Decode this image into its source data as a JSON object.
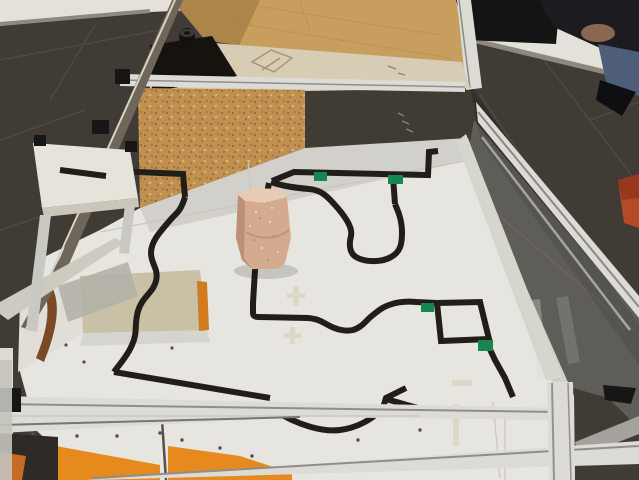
{
  "image": {
    "width": 639,
    "height": 480,
    "kind": "photograph",
    "subject": "Line-following robot test arena: aluminum-profile table with glass side walls, white boards carrying a black tape track with green corner markers, a standing brick obstacle, wooden ramps with orange faces, plywood back wall and cork divider, dark tiled floor, spectator sitting at top right"
  },
  "scene_objects": [
    "dark tiled floor",
    "white wall",
    "plywood back wall",
    "cork divider wall",
    "beige rear compartment board with pencil sketch",
    "black tape roll",
    "aluminum profile frame rails and posts",
    "glass side panels",
    "white track surface boards",
    "black tape track line",
    "green corner markers",
    "standing brick obstacle",
    "wooden ramp wedges with orange faces",
    "small white side table",
    "black corner brackets",
    "spectator sitting on floor",
    "dark bag against wall",
    "orange object at right edge"
  ],
  "colors": {
    "floor": "#403b35",
    "grout": "#5c554b",
    "wall": "#e4e1da",
    "baseboard": "#8e897f",
    "plywood": "#c79e5e",
    "plywood_shade": "#a87f42",
    "cork": "#bf9050",
    "cork_dot": "#8a5f33",
    "beige_floor": "#d7cdb4",
    "dark_gap": "#16130e",
    "surface": "#e7e5df",
    "surface_back_shade": "#b8b5ac",
    "track": "#211e1a",
    "marker": "#17874f",
    "brick_front": "#d5ab90",
    "brick_top": "#e7cbb4",
    "brick_side": "#bc8f78",
    "ramp_tan": "#c8c1a6",
    "ramp_orange": "#e68a1e",
    "ramp_orange_dark": "#cf7b1e",
    "ramp_brown": "#7a4a26",
    "alu_light": "#dcdbd6",
    "alu_mid": "#a3a29c",
    "alu_dark": "#71706b",
    "bronze": "#6e665a",
    "glass": "#b9bbb4",
    "dark_object": "#141414",
    "person_top": "#1c1c20",
    "jeans": "#4f5e78",
    "skin": "#8a6750",
    "shoe": "#0f0f12",
    "orange_object": "#b34a28",
    "bench_top": "#e6e3da",
    "bench_edge": "#cbc6b9",
    "shelf": "#b2afa8",
    "cap_black": "#161616",
    "screw": "#55504a"
  },
  "track": {
    "stroke_width": 6,
    "paths": {
      "bench_line": "M60,169 L104,175 M117,171 L183,174 L185,197",
      "s_curve": "M185,197 C181,210 178,212 172,218 C158,234 151,242 151,253 C151,264 159,269 156,281 C153,293 142,297 138,311 C134,325 138,332 132,345 C127,357 118,366 114,372",
      "ramp_diagonal": "M114,372 L270,398",
      "below_rail": "M272,409 C300,427 325,432 340,430 C356,428 372,420 383,408 M383,408 L386,398 L406,388 M386,399 L407,405 L440,414",
      "top_line": "M272,181 L294,172 L428,175 L429,152 L438,151",
      "stub": "M393,177 L395,204",
      "pocket": "M395,204 C399,213 402,221 402,233 C402,245 400,252 391,257 C381,263 364,262 356,257 C349,253 349,243 351,236 C353,227 344,215 335,205 C327,196 321,190 309,189 C297,188 282,186 271,182",
      "under_brick": "M269,183 L258,240 L255,270",
      "mid_curve": "M255,270 L253,303 L253,313 C253,316 255,317 259,317 L308,318 C319,319 322,322 328,325 C335,329 345,332 353,330 C363,327 367,319 373,315 C378,311 381,308 389,305 C397,302 405,301 416,302 L437,303",
      "square_loop": "M437,303 L480,302 L489,339 L441,341 Z",
      "square_exit": "M487,343 L495,360 L505,378 L513,397"
    },
    "markers": [
      {
        "x": 314,
        "y": 172,
        "w": 13,
        "h": 9
      },
      {
        "x": 388,
        "y": 175,
        "w": 15,
        "h": 9
      },
      {
        "x": 421,
        "y": 303,
        "w": 13,
        "h": 9
      },
      {
        "x": 478,
        "y": 340,
        "w": 15,
        "h": 11
      }
    ]
  }
}
